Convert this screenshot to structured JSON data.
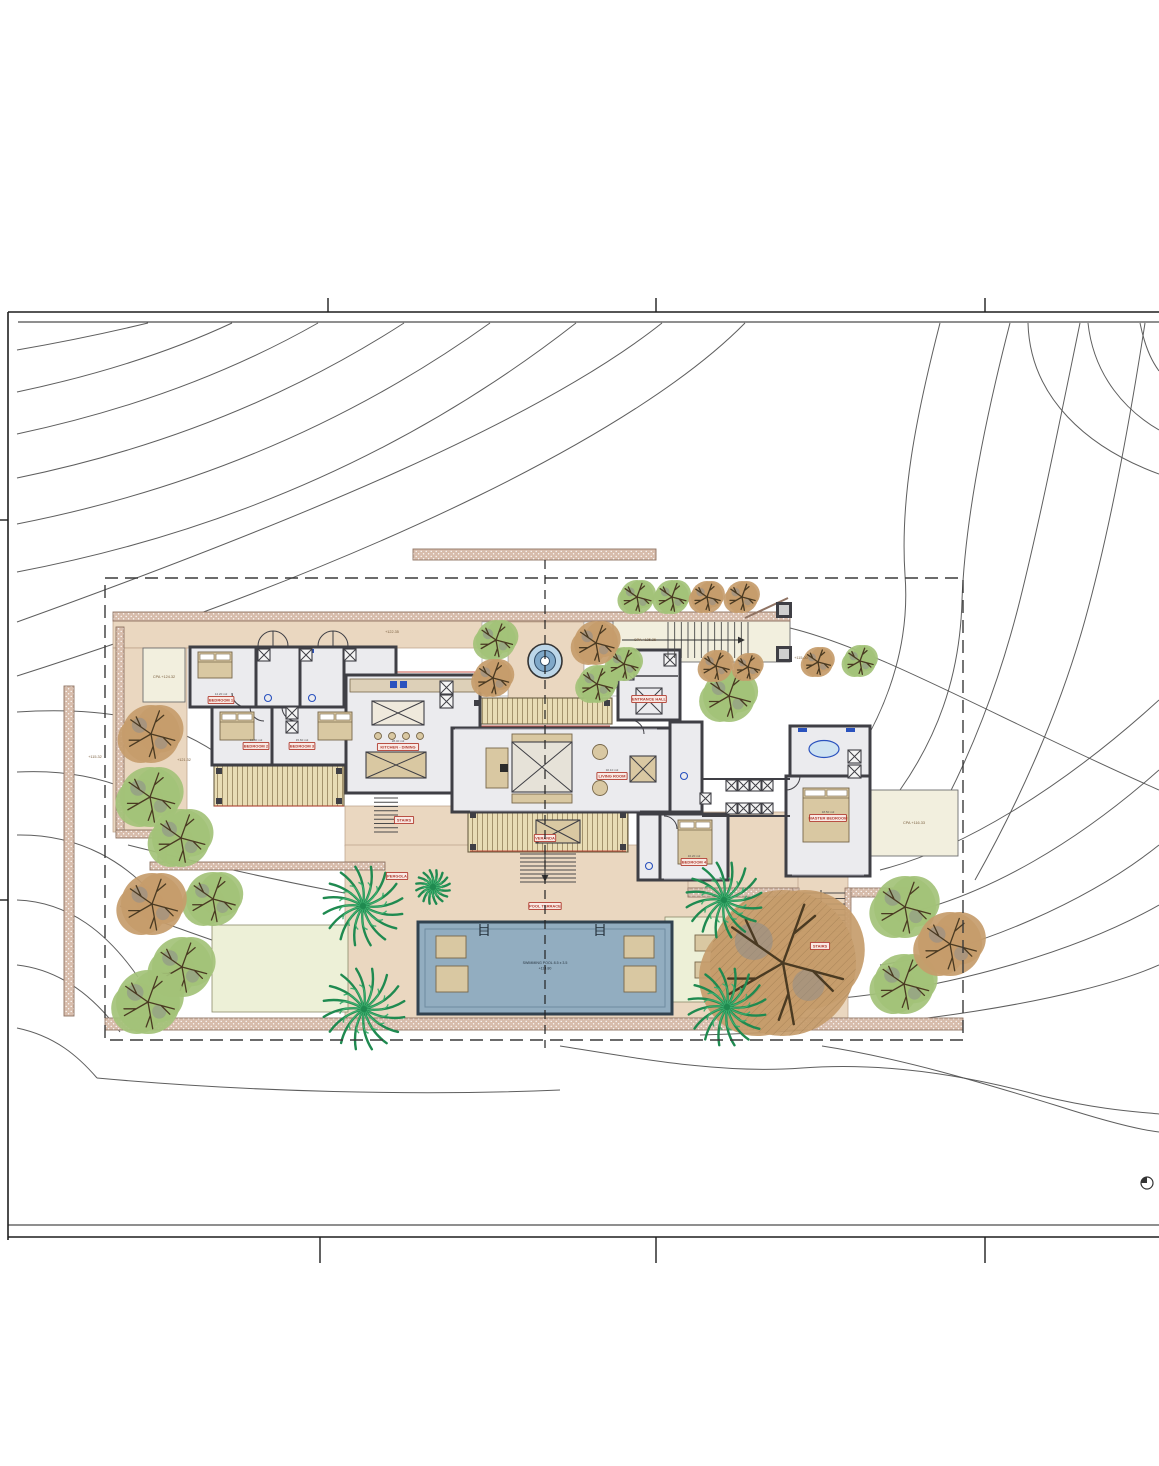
{
  "drawing": {
    "kind": "architectural site plan",
    "north_symbol": "north-indicator"
  },
  "room_labels": [
    {
      "text": "BEDROOM 1",
      "area": "14.20 m2",
      "x": 221,
      "y": 700
    },
    {
      "text": "BEDROOM 2",
      "area": "13.80 m2",
      "x": 256,
      "y": 746
    },
    {
      "text": "BEDROOM 3",
      "area": "15.60 m2",
      "x": 302,
      "y": 746
    },
    {
      "text": "KITCHEN - DINING",
      "area": "28.40 m2",
      "x": 398,
      "y": 747
    },
    {
      "text": "LIVING ROOM",
      "area": "32.10 m2",
      "x": 612,
      "y": 776
    },
    {
      "text": "ENTRANCE HALL",
      "area": "",
      "x": 649,
      "y": 699
    },
    {
      "text": "VERANDA",
      "area": "",
      "x": 545,
      "y": 838
    },
    {
      "text": "STAIRS",
      "area": "",
      "x": 404,
      "y": 820
    },
    {
      "text": "PERGOLA",
      "area": "",
      "x": 397,
      "y": 876
    },
    {
      "text": "POOL TERRACE",
      "area": "",
      "x": 545,
      "y": 906
    },
    {
      "text": "BEDROOM 4",
      "area": "16.20 m2",
      "x": 694,
      "y": 862
    },
    {
      "text": "MASTER BEDROOM",
      "area": "18.50 m2",
      "x": 828,
      "y": 818
    },
    {
      "text": "STAIRS",
      "area": "",
      "x": 820,
      "y": 946
    }
  ],
  "elevation_labels": [
    {
      "text": "CPA +124.32",
      "x": 164,
      "y": 678
    },
    {
      "text": "CPA +125.35",
      "x": 645,
      "y": 641
    },
    {
      "text": "CPA +116.33",
      "x": 914,
      "y": 824
    },
    {
      "text": "+115.00",
      "x": 801,
      "y": 659
    },
    {
      "text": "+115.32",
      "x": 95,
      "y": 758
    },
    {
      "text": "+121.32",
      "x": 184,
      "y": 761
    },
    {
      "text": "+122.35",
      "x": 392,
      "y": 633
    }
  ],
  "pool": {
    "line1": "SWIMMING POOL 8.5 x 3.5",
    "line2": "+114.80"
  },
  "landscape": {
    "deciduous": [
      {
        "variant": "green",
        "x": 496,
        "y": 640,
        "r": 20
      },
      {
        "variant": "green",
        "x": 597,
        "y": 684,
        "r": 19
      },
      {
        "variant": "green",
        "x": 624,
        "y": 664,
        "r": 17
      },
      {
        "variant": "green",
        "x": 637,
        "y": 597,
        "r": 17
      },
      {
        "variant": "green",
        "x": 672,
        "y": 597,
        "r": 17
      },
      {
        "variant": "green",
        "x": 860,
        "y": 661,
        "r": 16
      },
      {
        "variant": "green",
        "x": 729,
        "y": 696,
        "r": 26
      },
      {
        "variant": "green",
        "x": 150,
        "y": 797,
        "r": 30
      },
      {
        "variant": "green",
        "x": 181,
        "y": 838,
        "r": 29
      },
      {
        "variant": "green",
        "x": 213,
        "y": 899,
        "r": 27
      },
      {
        "variant": "green",
        "x": 182,
        "y": 967,
        "r": 30
      },
      {
        "variant": "green",
        "x": 148,
        "y": 1002,
        "r": 32
      },
      {
        "variant": "green",
        "x": 905,
        "y": 907,
        "r": 31
      },
      {
        "variant": "green",
        "x": 904,
        "y": 984,
        "r": 30
      },
      {
        "variant": "brown",
        "x": 493,
        "y": 678,
        "r": 19
      },
      {
        "variant": "brown",
        "x": 596,
        "y": 643,
        "r": 22
      },
      {
        "variant": "brown",
        "x": 707,
        "y": 597,
        "r": 16
      },
      {
        "variant": "brown",
        "x": 742,
        "y": 597,
        "r": 16
      },
      {
        "variant": "brown",
        "x": 818,
        "y": 662,
        "r": 15
      },
      {
        "variant": "brown",
        "x": 716,
        "y": 666,
        "r": 16
      },
      {
        "variant": "brown",
        "x": 748,
        "y": 667,
        "r": 14
      },
      {
        "variant": "brown",
        "x": 151,
        "y": 734,
        "r": 29
      },
      {
        "variant": "brown",
        "x": 152,
        "y": 904,
        "r": 31
      },
      {
        "variant": "brown",
        "x": 950,
        "y": 944,
        "r": 32
      },
      {
        "variant": "brown-large",
        "x": 783,
        "y": 963,
        "r": 73
      }
    ],
    "palms": [
      {
        "x": 363,
        "y": 906,
        "r": 40
      },
      {
        "x": 364,
        "y": 1009,
        "r": 41
      },
      {
        "x": 724,
        "y": 900,
        "r": 38
      },
      {
        "x": 727,
        "y": 1007,
        "r": 39
      },
      {
        "x": 433,
        "y": 887,
        "r": 17
      }
    ]
  },
  "colors": {
    "labelRed": "#b03a2e",
    "poolWater": "#92adc0",
    "treeGreen": "#a3c278",
    "treeBrown": "#c59c6b",
    "palmGreen": "#27995c",
    "paving": "#ead7c0",
    "contour": "#4d4d4d"
  }
}
